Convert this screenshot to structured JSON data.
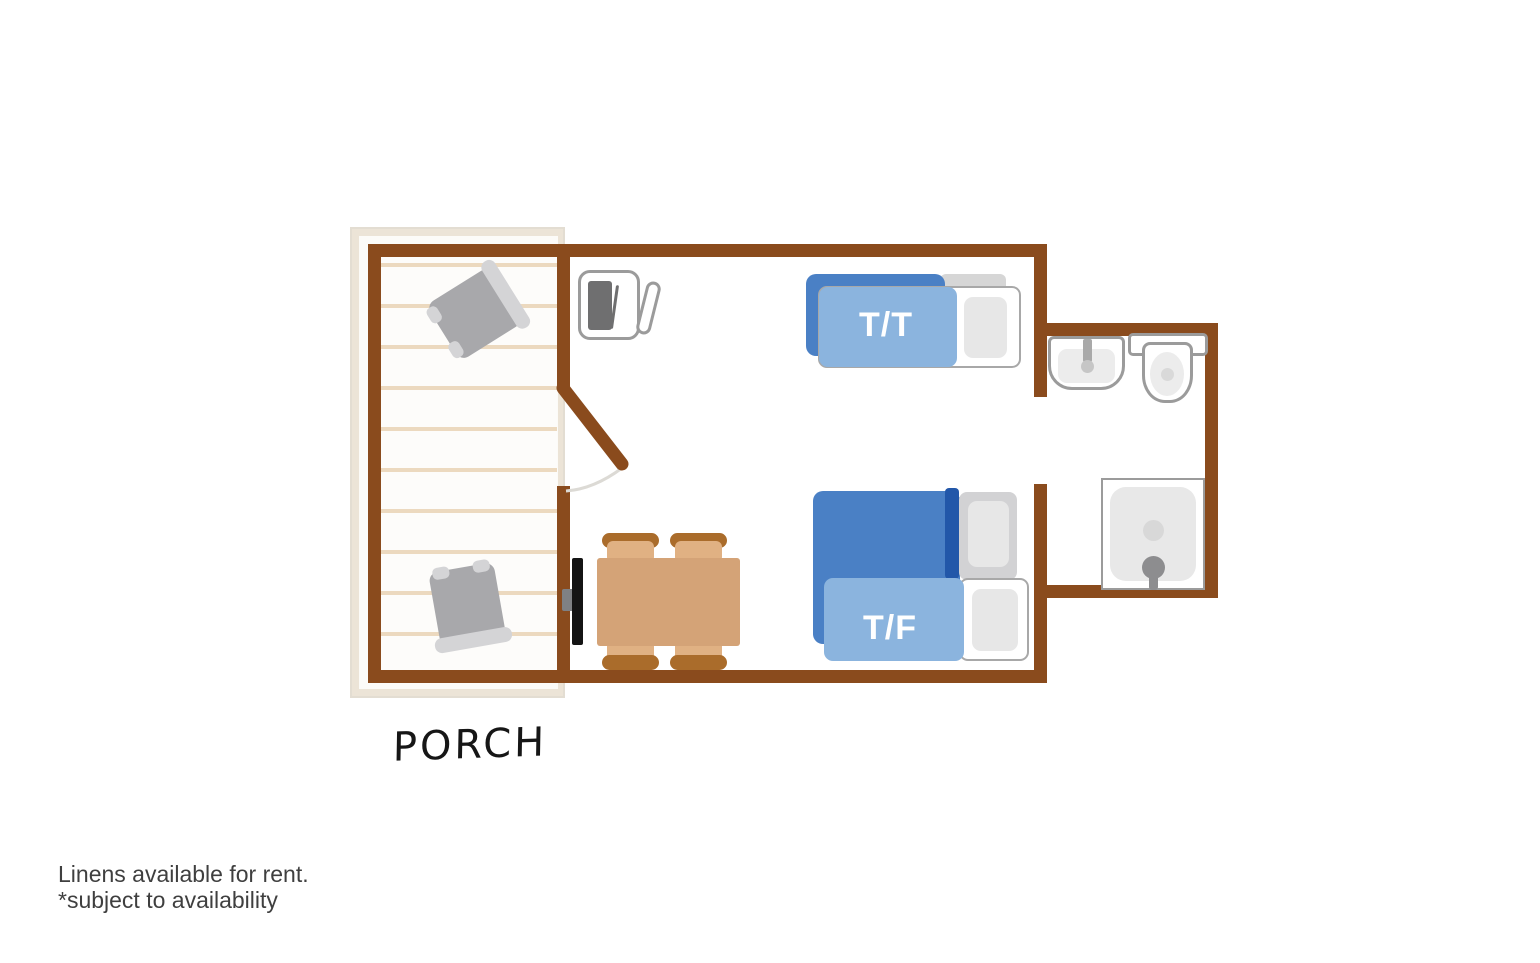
{
  "labels": {
    "porch": "PORCH",
    "bed_tt": "T/T",
    "bed_tf": "T/F"
  },
  "notes": {
    "line1": "Linens available for rent.",
    "line2": "*subject to availability"
  },
  "colors": {
    "wall_brown": "#8a4b1d",
    "porch_band": "#ece4d7",
    "porch_plank": "#ecd9bf",
    "bed_dark_blue": "#4a80c5",
    "bed_light_blue": "#8bb4de",
    "bed_navy_stripe": "#2257a9",
    "mattress_white": "#ffffff",
    "pillow_gray": "#e7e7e7",
    "table_tan": "#d4a377",
    "chair_seat_tan": "#e0b183",
    "chair_back_brown": "#aa6c2b",
    "tv_black": "#141414",
    "fixture_outline_gray": "#9b9b9b",
    "porch_chair_gray": "#a8a8ab",
    "note_text": "#3f3f3f"
  },
  "rooms": [
    {
      "name": "porch",
      "label": "PORCH"
    },
    {
      "name": "main-room",
      "label": ""
    },
    {
      "name": "bathroom",
      "label": ""
    }
  ],
  "furniture": [
    {
      "icon": "porch-chair-icon",
      "count": 2,
      "location": "porch"
    },
    {
      "icon": "mini-fridge-icon",
      "count": 1,
      "location": "main-room"
    },
    {
      "icon": "bunk-bed-twin-twin-icon",
      "label": "T/T",
      "location": "main-room"
    },
    {
      "icon": "bunk-bed-twin-full-icon",
      "label": "T/F",
      "location": "main-room"
    },
    {
      "icon": "dining-table-icon",
      "count": 1,
      "location": "main-room"
    },
    {
      "icon": "dining-chair-icon",
      "count": 4,
      "location": "main-room"
    },
    {
      "icon": "tv-icon",
      "count": 1,
      "location": "main-room"
    },
    {
      "icon": "door-icon",
      "count": 1,
      "location": "porch-to-main"
    },
    {
      "icon": "sink-icon",
      "count": 1,
      "location": "bathroom"
    },
    {
      "icon": "toilet-icon",
      "count": 1,
      "location": "bathroom"
    },
    {
      "icon": "shower-icon",
      "count": 1,
      "location": "bathroom"
    }
  ]
}
